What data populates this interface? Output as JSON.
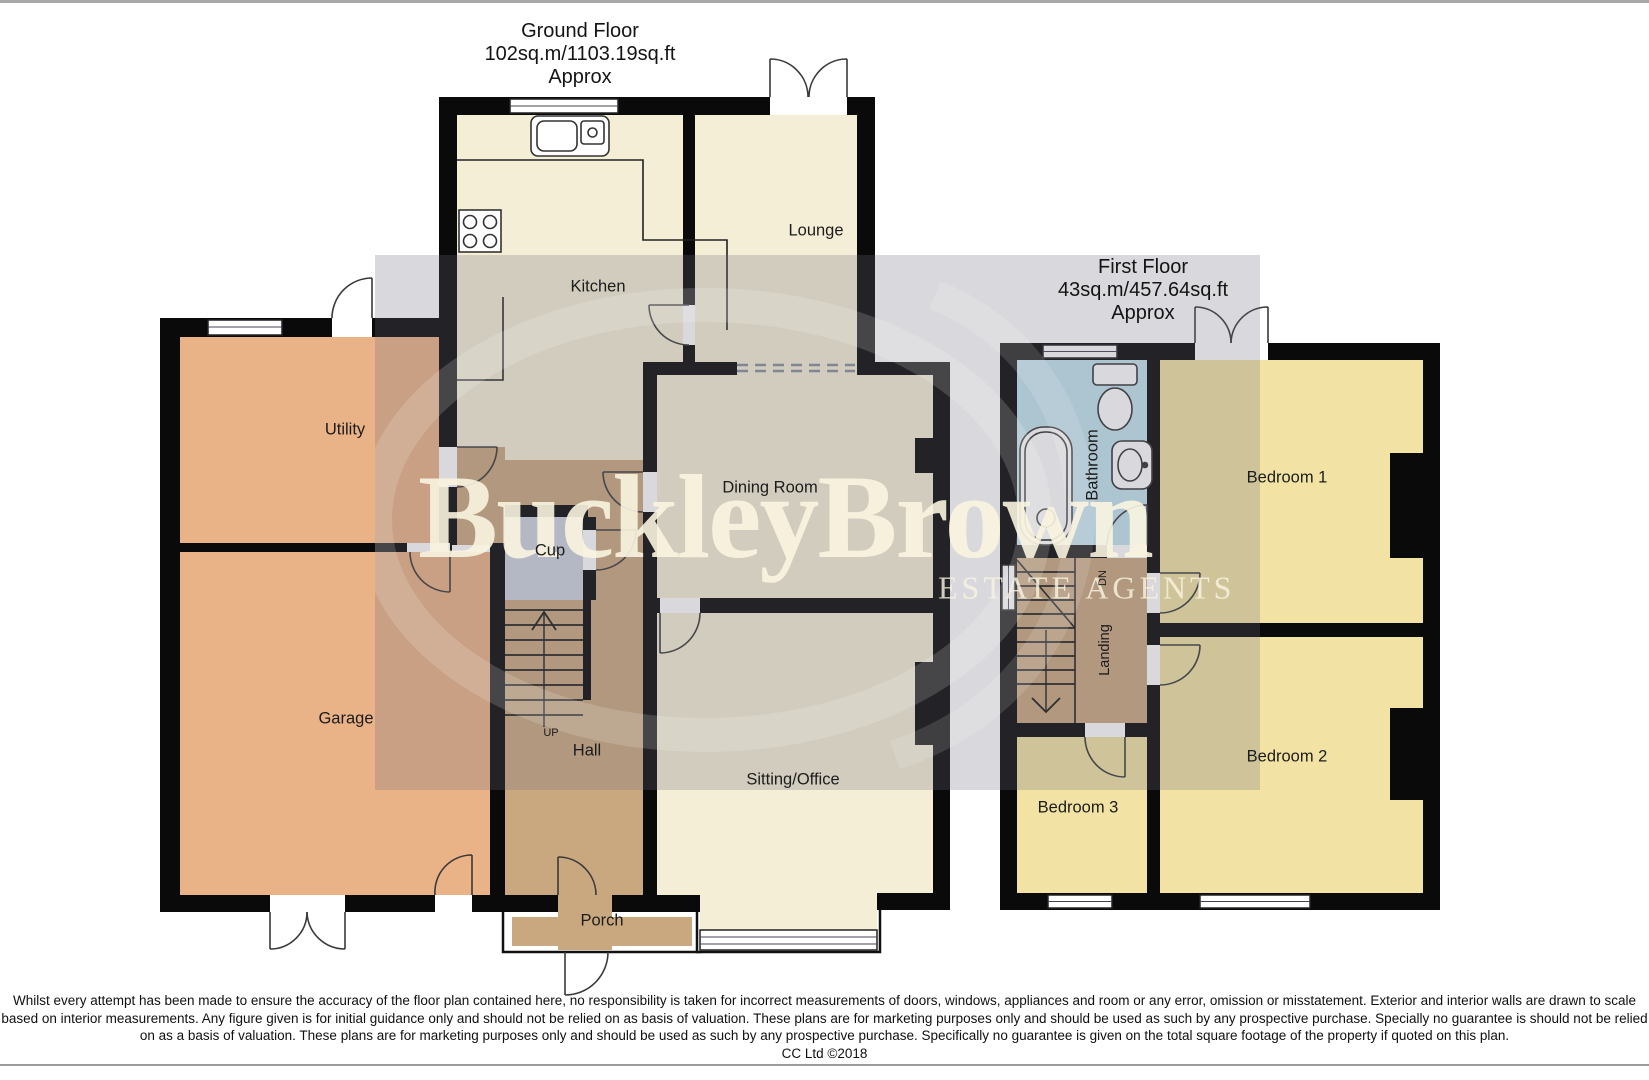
{
  "ground_floor": {
    "title": "Ground Floor",
    "area": "102sq.m/1103.19sq.ft",
    "approx": "Approx",
    "rooms": {
      "kitchen": "Kitchen",
      "lounge": "Lounge",
      "utility": "Utility",
      "garage": "Garage",
      "dining": "Dining Room",
      "cup": "Cup",
      "hall": "Hall",
      "up": "UP",
      "sitting": "Sitting/Office",
      "porch": "Porch"
    }
  },
  "first_floor": {
    "title": "First Floor",
    "area": "43sq.m/457.64sq.ft",
    "approx": "Approx",
    "rooms": {
      "bathroom": "Bathroom",
      "bedroom1": "Bedroom 1",
      "landing": "Landing",
      "dn": "DN",
      "bedroom2": "Bedroom 2",
      "bedroom3": "Bedroom 3"
    }
  },
  "watermark": {
    "name": "BuckleyBrown",
    "tagline": "ESTATE AGENTS"
  },
  "footer": {
    "line1": "Whilst every attempt has been made to ensure the accuracy of the floor plan contained here, no responsibility is taken for incorrect measurements of doors, windows, appliances and room or any error, omission or misstatement. Exterior and interior walls are drawn to scale",
    "line2": "based on interior measurements. Any figure given is for initial guidance only and should not be relied on as basis of valuation. These plans are for marketing purposes only and should be used as such by any prospective purchase. Specially no guarantee is should not be relied",
    "line3": "on as a basis of valuation. These plans are for marketing purposes only and should be used as such by any prospective purchase. Specifically no guarantee is given on the total square footage of the property if quoted on this plan.",
    "copyright": "CC Ltd ©2018"
  },
  "colors": {
    "wall": "#0a0a0a",
    "cream_room": "#f4eed6",
    "orange_room": "#eab287",
    "tan_hall": "#c9a87f",
    "cup_gray": "#ced2de",
    "bathroom_blue": "#c4e5ef",
    "bedroom_yellow": "#f2e3a4",
    "watermark_text": "#f7f1da",
    "overlay_gray": "rgba(109,109,122,0.26)"
  }
}
